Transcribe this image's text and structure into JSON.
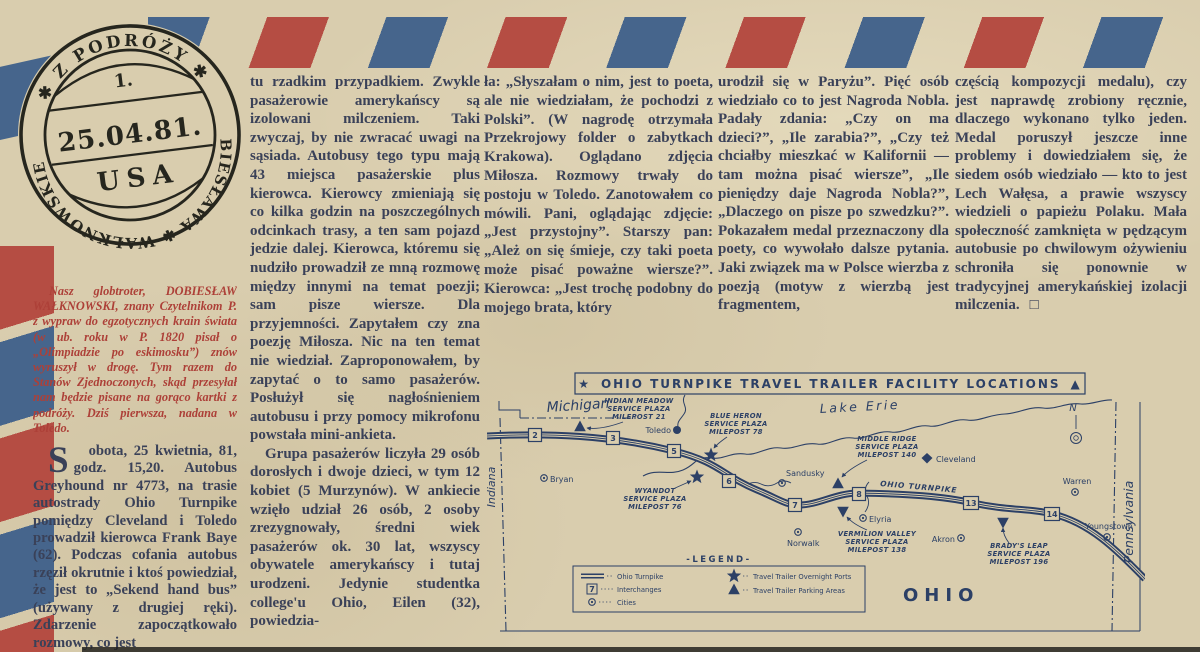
{
  "stamp": {
    "ring_top": "✱  Z PODRÓŻY  ✱",
    "ring_bottom": "DOBIESŁAWA ✱ WAŁKNOWSKIEGO",
    "number": "1.",
    "date": "25.04.81.",
    "country": "USA"
  },
  "article": {
    "intro": "Nasz globtroter, DOBIESŁAW WAŁKNOWSKI, znany Czytelnikom P. z wypraw do egzotycznych krain świata (w ub. roku w P. 1820 pisał o „Olimpiadzie po eskimosku”) znów wyruszył w drogę. Tym razem do Stanów Zjednoczonych, skąd przesyłał nam będzie pisane na gorąco kartki z podróży. Dziś pierwsza, nadana w Toledo.",
    "col1": "Sobota, 25 kwietnia, 81, godz. 15,20. Autobus Greyhound nr 4773, na trasie autostrady Ohio Turnpike pomiędzy Cleveland i Toledo prowadził kierowca Frank Baye (62). Podczas cofania autobus rzęził okrutnie i ktoś powiedział, że jest to „Sekend hand bus” (używany z drugiej ręki). Zdarzenie zapoczątkowało rozmowy, co jest",
    "col2a": "tu rzadkim przypadkiem. Zwykle pasażerowie amerykańscy są izolowani milczeniem. Taki zwyczaj, by nie zwracać uwagi na sąsiada. Autobusy tego typu mają 43 miejsca pasażerskie plus kierowca. Kierowcy zmieniają się co kilka godzin na poszczególnych odcinkach trasy, a ten sam pojazd jedzie dalej. Kierowca, któremu się nudziło prowadził ze mną rozmowę między innymi na temat poezji; sam pisze wiersze. Dla przyjemności. Zapytałem czy zna poezję Miłosza. Nic na ten temat nie wiedział. Zaproponowałem, by zapytać o to samo pasażerów. Posłużył się nagłośnieniem autobusu i przy pomocy mikrofonu powstała mini-ankieta.",
    "col2b": "Grupa pasażerów liczyła 29 osób dorosłych i dwoje dzieci, w tym 12 kobiet (5 Murzynów). W ankiecie wzięło udział 26 osób, 2 osoby zrezygnowały, średni wiek pasażerów ok. 30 lat, wszyscy obywatele amerykańscy i tutaj urodzeni. Jedynie studentka college'u Ohio, Eilen (32), powiedzia-",
    "col3": "ła: „Słyszałam o nim, jest to poeta, ale nie wiedziałam, że pochodzi z Polski”. (W nagrodę otrzymała Przekrojowy folder o zabytkach Krakowa). Oglądano zdjęcia Miłosza. Rozmowy trwały do postoju w Toledo. Zanotowałem co mówili. Pani, oglądając zdjęcie: „Jest przystojny”. Starszy pan: „Ależ on się śmieje, czy taki poeta może pisać poważne wiersze?”. Kierowca: „Jest trochę podobny do mojego brata, który",
    "col4": "urodził się w Paryżu”. Pięć osób wiedziało co to jest Nagroda Nobla. Padały zdania: „Czy on ma dzieci?”, „Ile zarabia?”, „Czy też chciałby mieszkać w Kalifornii — tam można pisać wiersze”, „Ile pieniędzy daje Nagroda Nobla?”, „Dlaczego on pisze po szwedzku?”. Pokazałem medal przeznaczony dla poety, co wywołało dalsze pytania. Jaki związek ma w Polsce wierzba z poezją (motyw z wierzbą jest fragmentem,",
    "col5": "częścią kompozycji medalu), czy jest naprawdę zrobiony ręcznie, dlaczego wykonano tylko jeden. Medal poruszył jeszcze inne problemy i dowiedziałem się, że siedem osób wiedziało — kto to jest Lech Wałęsa, a prawie wszyscy wiedzieli o papieżu Polaku. Mała społeczność zamknięta w pędzącym autobusie po chwilowym ożywieniu schroniła się ponownie w tradycyjnej amerykańskiej izolacji milczenia.",
    "end_mark": "□"
  },
  "map": {
    "title": "OHIO TURNPIKE TRAVEL TRAILER FACILITY LOCATIONS",
    "title_star": "★",
    "title_triangle": "▲",
    "states": {
      "michigan": "Michigan",
      "indiana": "Indiana",
      "pennsylvania": "Pennsylvania",
      "ohio": "OHIO"
    },
    "lake": "Lake Erie",
    "road_label": "OHIO TURNPIKE",
    "compass": "N",
    "interchanges": [
      "2",
      "3",
      "5",
      "6",
      "7",
      "8",
      "13",
      "14"
    ],
    "cities": [
      {
        "name": "Toledo"
      },
      {
        "name": "Bryan"
      },
      {
        "name": "Sandusky"
      },
      {
        "name": "Norwalk"
      },
      {
        "name": "Elyria"
      },
      {
        "name": "Cleveland"
      },
      {
        "name": "Warren"
      },
      {
        "name": "Akron"
      },
      {
        "name": "Youngstown"
      }
    ],
    "plazas": [
      {
        "l1": "INDIAN MEADOW",
        "l2": "SERVICE PLAZA",
        "l3": "MILEPOST 21"
      },
      {
        "l1": "BLUE HERON",
        "l2": "SERVICE PLAZA",
        "l3": "MILEPOST 78"
      },
      {
        "l1": "WYANDOT",
        "l2": "SERVICE PLAZA",
        "l3": "MILEPOST 76"
      },
      {
        "l1": "MIDDLE RIDGE",
        "l2": "SERVICE PLAZA",
        "l3": "MILEPOST 140"
      },
      {
        "l1": "VERMILION VALLEY",
        "l2": "SERVICE PLAZA",
        "l3": "MILEPOST 138"
      },
      {
        "l1": "BRADY'S LEAP",
        "l2": "SERVICE PLAZA",
        "l3": "MILEPOST 196"
      }
    ],
    "legend": {
      "title": "-LEGEND-",
      "interchange_number": "7",
      "left": [
        "Ohio Turnpike",
        "Interchanges",
        "Cities"
      ],
      "right": [
        "Travel Trailer Overnight Ports",
        "Travel Trailer Parking Areas"
      ]
    }
  },
  "colors": {
    "stripe_red": "#b54d43",
    "stripe_blue": "#46658c",
    "ink_text": "#3a4158",
    "ink_red": "#ad4038",
    "map_ink": "#2c4066",
    "paper": "#d9cdae"
  }
}
